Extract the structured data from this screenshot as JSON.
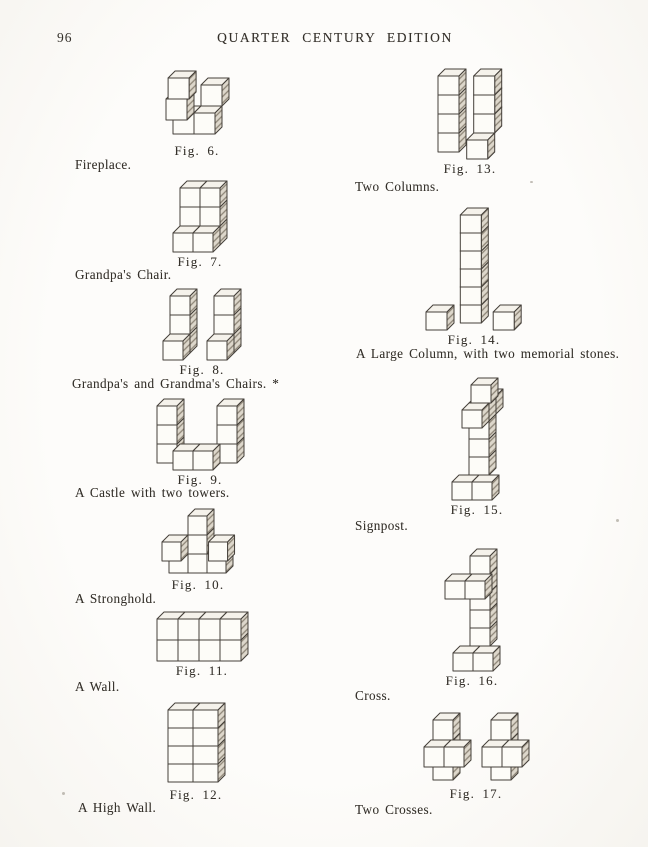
{
  "page": {
    "number": "96",
    "header": "QUARTER CENTURY EDITION",
    "background": "#fdfcfa",
    "ink": "#34302a"
  },
  "engraving": {
    "stroke": "#45403a",
    "face": "#fdfcf8",
    "top": "#f5f2eb",
    "shade_bg": "#ddd7cb",
    "shade_line": "#8d8577"
  },
  "figures": [
    {
      "id": "fig6",
      "caption": "Fig. 6.",
      "label": "Fireplace.",
      "blocks": [
        [
          0,
          0,
          0
        ],
        [
          1,
          0,
          0
        ],
        [
          0,
          1,
          1
        ],
        [
          1,
          1,
          -1
        ],
        [
          0.1,
          2,
          1
        ]
      ]
    },
    {
      "id": "fig7",
      "caption": "Fig. 7.",
      "label": "Grandpa's Chair.",
      "blocks": [
        [
          0,
          0,
          0
        ],
        [
          1,
          0,
          0
        ],
        [
          0,
          1,
          0
        ],
        [
          1,
          1,
          0
        ],
        [
          0,
          2,
          0
        ],
        [
          1,
          2,
          0
        ],
        [
          0,
          0,
          1
        ],
        [
          1,
          0,
          1
        ]
      ]
    },
    {
      "id": "fig8",
      "caption": "Fig. 8.",
      "label": "Grandpa's and Grandma's Chairs. *",
      "blocks": [
        [
          0,
          0,
          0
        ],
        [
          0,
          1,
          0
        ],
        [
          0,
          2,
          0
        ],
        [
          0,
          0,
          1
        ],
        [
          2.2,
          0,
          0
        ],
        [
          2.2,
          1,
          0
        ],
        [
          2.2,
          2,
          0
        ],
        [
          2.2,
          0,
          1
        ]
      ]
    },
    {
      "id": "fig9",
      "caption": "Fig. 9.",
      "label": "A Castle with two towers.",
      "blocks": [
        [
          0,
          0,
          0
        ],
        [
          0,
          1,
          0
        ],
        [
          0,
          2,
          0
        ],
        [
          3,
          0,
          0
        ],
        [
          3,
          1,
          0
        ],
        [
          3,
          2,
          0
        ],
        [
          1.15,
          0,
          1
        ],
        [
          2.15,
          0,
          1
        ]
      ]
    },
    {
      "id": "fig10",
      "caption": "Fig. 10.",
      "label": "A Stronghold.",
      "blocks": [
        [
          0,
          0,
          0
        ],
        [
          1,
          0,
          0
        ],
        [
          2,
          0,
          0
        ],
        [
          1,
          1,
          0
        ],
        [
          1,
          2,
          0
        ],
        [
          0,
          1,
          1
        ],
        [
          2.45,
          1,
          1
        ]
      ]
    },
    {
      "id": "fig11",
      "caption": "Fig. 11.",
      "label": "A Wall.",
      "blocks": [
        [
          0,
          0,
          0
        ],
        [
          1,
          0,
          0
        ],
        [
          2,
          0,
          0
        ],
        [
          3,
          0,
          0
        ],
        [
          0,
          1,
          0
        ],
        [
          1,
          1,
          0
        ],
        [
          2,
          1,
          0
        ],
        [
          3,
          1,
          0
        ]
      ]
    },
    {
      "id": "fig12",
      "caption": "Fig. 12.",
      "label": "A High Wall.",
      "blocks": [
        [
          0,
          0,
          0
        ],
        [
          1,
          0,
          0
        ],
        [
          0,
          1,
          0
        ],
        [
          1,
          1,
          0
        ],
        [
          0,
          2,
          0
        ],
        [
          1,
          2,
          0
        ],
        [
          0,
          3,
          0
        ],
        [
          1,
          3,
          0
        ]
      ]
    },
    {
      "id": "fig13",
      "caption": "Fig. 13.",
      "label": "Two Columns.",
      "blocks": [
        [
          0,
          0,
          0
        ],
        [
          0,
          1,
          0
        ],
        [
          0,
          2,
          0
        ],
        [
          0,
          3,
          0
        ],
        [
          1.7,
          1,
          0
        ],
        [
          1.7,
          2,
          0
        ],
        [
          1.7,
          3,
          0
        ],
        [
          1.7,
          0,
          1
        ]
      ]
    },
    {
      "id": "fig14",
      "caption": "Fig. 14.",
      "label": "A Large Column, with two memorial stones.",
      "blocks": [
        [
          1.8,
          0,
          0
        ],
        [
          1.8,
          1,
          0
        ],
        [
          1.8,
          2,
          0
        ],
        [
          1.8,
          3,
          0
        ],
        [
          1.8,
          4,
          0
        ],
        [
          1.8,
          5,
          0
        ],
        [
          0.5,
          0,
          1
        ],
        [
          3.7,
          0,
          1
        ]
      ]
    },
    {
      "id": "fig15",
      "caption": "Fig. 15.",
      "label": "Signpost.",
      "blocks": [
        [
          0,
          0,
          1
        ],
        [
          1,
          0,
          1
        ],
        [
          0.5,
          1,
          0
        ],
        [
          0.5,
          2,
          0
        ],
        [
          0.5,
          3,
          0
        ],
        [
          0.5,
          4,
          -1
        ],
        [
          0.5,
          4,
          0
        ],
        [
          0.5,
          4,
          1
        ],
        [
          0.6,
          5,
          0
        ]
      ]
    },
    {
      "id": "fig16",
      "caption": "Fig. 16.",
      "label": "Cross.",
      "blocks": [
        [
          0,
          0,
          1
        ],
        [
          1,
          0,
          1
        ],
        [
          0.5,
          1,
          0
        ],
        [
          0.5,
          2,
          0
        ],
        [
          0.5,
          3,
          0
        ],
        [
          0.5,
          4,
          0
        ],
        [
          -0.4,
          4,
          1
        ],
        [
          0.6,
          4,
          1
        ],
        [
          0.5,
          5,
          0
        ]
      ]
    },
    {
      "id": "fig17",
      "caption": "Fig. 17.",
      "label": "Two Crosses.",
      "blocks": [
        [
          0.1,
          0,
          0
        ],
        [
          0.1,
          1,
          0
        ],
        [
          0.1,
          2,
          0
        ],
        [
          0,
          1,
          1
        ],
        [
          1,
          1,
          1
        ],
        [
          3.0,
          0,
          0
        ],
        [
          3.0,
          1,
          0
        ],
        [
          3.0,
          2,
          0
        ],
        [
          2.9,
          1,
          1
        ],
        [
          3.9,
          1,
          1
        ]
      ]
    }
  ]
}
